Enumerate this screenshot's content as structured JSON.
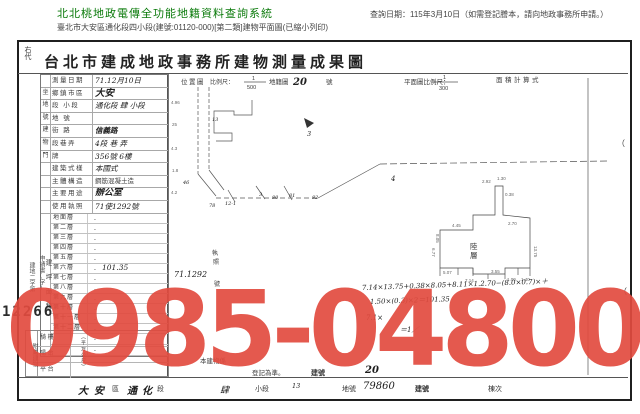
{
  "header": {
    "system_title": "北北桃地政電傳全功能地籍資料查詢系統",
    "query_date": "查詢日期：115年3月10日（如需登記謄本，請向地政事務所申請。）",
    "doc_line": "臺北市大安區通化段四小段(建號:01120-000)[第二類]建物平面圖(已縮小列印)"
  },
  "watermark": {
    "text": "0985-048006",
    "color": "#e24b3f"
  },
  "doc": {
    "corner": "右代",
    "title": "台北市建成地政事務所建物測量成果圖",
    "stamp_number": "12266",
    "side_note_a": "申請書(字)",
    "side_note_b": "建地二字第",
    "info_rows": [
      {
        "g": "",
        "label": "測量日期",
        "value": "71.12月10日"
      },
      {
        "g": "坐",
        "label": "鄉鎮市區",
        "value": "大安"
      },
      {
        "g": "地",
        "label": "段 小段",
        "value": "通化段 肆 小段"
      },
      {
        "g": "號",
        "label": "地 號",
        "value": ""
      },
      {
        "g": "建",
        "label": "街 路",
        "value": "信義路"
      },
      {
        "g": "物",
        "label": "段巷弄",
        "value": "4段 巷 弄"
      },
      {
        "g": "門",
        "label": "牌",
        "value": "356號 6樓"
      },
      {
        "g": "",
        "label": "建築式樣",
        "value": "本國式"
      },
      {
        "g": "",
        "label": "主體構造",
        "value": "鋼筋混凝土造"
      },
      {
        "g": "",
        "label": "主要用途",
        "value": "辦公室"
      },
      {
        "g": "",
        "label": "使用執照",
        "value": "71使1292號"
      }
    ],
    "area_col": "建坪面積",
    "area_unit": "（平方公尺）",
    "floors": [
      {
        "label": "地面層",
        "value": ""
      },
      {
        "label": "第二層",
        "value": ""
      },
      {
        "label": "第三層",
        "value": ""
      },
      {
        "label": "第四層",
        "value": ""
      },
      {
        "label": "第五層",
        "value": ""
      },
      {
        "label": "第六層",
        "value": "101.35"
      },
      {
        "label": "第七層",
        "value": ""
      },
      {
        "label": "第八層",
        "value": ""
      },
      {
        "label": "第九層",
        "value": ""
      },
      {
        "label": "第十層",
        "value": ""
      },
      {
        "label": "第十一層",
        "value": ""
      },
      {
        "label": "第十二層",
        "value": ""
      }
    ],
    "annex_title": "附屬建物",
    "annex_rows": [
      {
        "label": "騎 樓",
        "value": ""
      },
      {
        "label": "陽 台",
        "value": ""
      },
      {
        "label": "平 台",
        "value": ""
      }
    ],
    "note": {
      "frag1": "本建物係",
      "frag2": "登記為準。",
      "bno_label": "建號",
      "bno_value": "20"
    },
    "footer": {
      "district_hw": "大安",
      "district": "區",
      "section_hw": "通化",
      "section": "段",
      "sub_hw": "肆",
      "sub": "小段",
      "lot_hw": "13",
      "lot": "地號",
      "bno_hw": "79860",
      "bno": "建號",
      "dong": "棟次"
    }
  },
  "plan": {
    "loc_label": "位置圖",
    "scale_label": "比例尺：",
    "scale_num": "1",
    "scale_den": "500",
    "map_label": "地籍圖",
    "map_no": "20",
    "map_suffix": "號",
    "plan_scale_label": "平面圖比例尺：",
    "plan_num": "1",
    "plan_den": "300",
    "calc_label": "面積計算式",
    "north_no": "3",
    "lot4": "4",
    "mark13": "13",
    "lots": [
      "46",
      "78",
      "12-1",
      "3",
      "80",
      "81",
      "82"
    ],
    "edge_nums": [
      "4.96",
      "25",
      "4.3",
      "1.8",
      "4.2"
    ],
    "permit_1": "執",
    "permit_2": "照",
    "permit_no": "71.1292",
    "permit_suffix": "號",
    "floor_c1": "陸",
    "floor_c2": "層",
    "dims": [
      "2.92",
      "0.38",
      "2.70",
      "4.45",
      "13.75",
      "6.77",
      "7.14",
      "3.55",
      "1.00",
      "1.40",
      "5.07",
      "1.30",
      "8.05"
    ],
    "calc1": "7.14×13.75+0.38×8.05+8.11×1.2.70−(8.0×0.7)×＋",
    "calc2": "1.50×(0.3)×2＝101.35",
    "calc3": "7.1×",
    "calc4": "＝1／",
    "paren": "（"
  }
}
